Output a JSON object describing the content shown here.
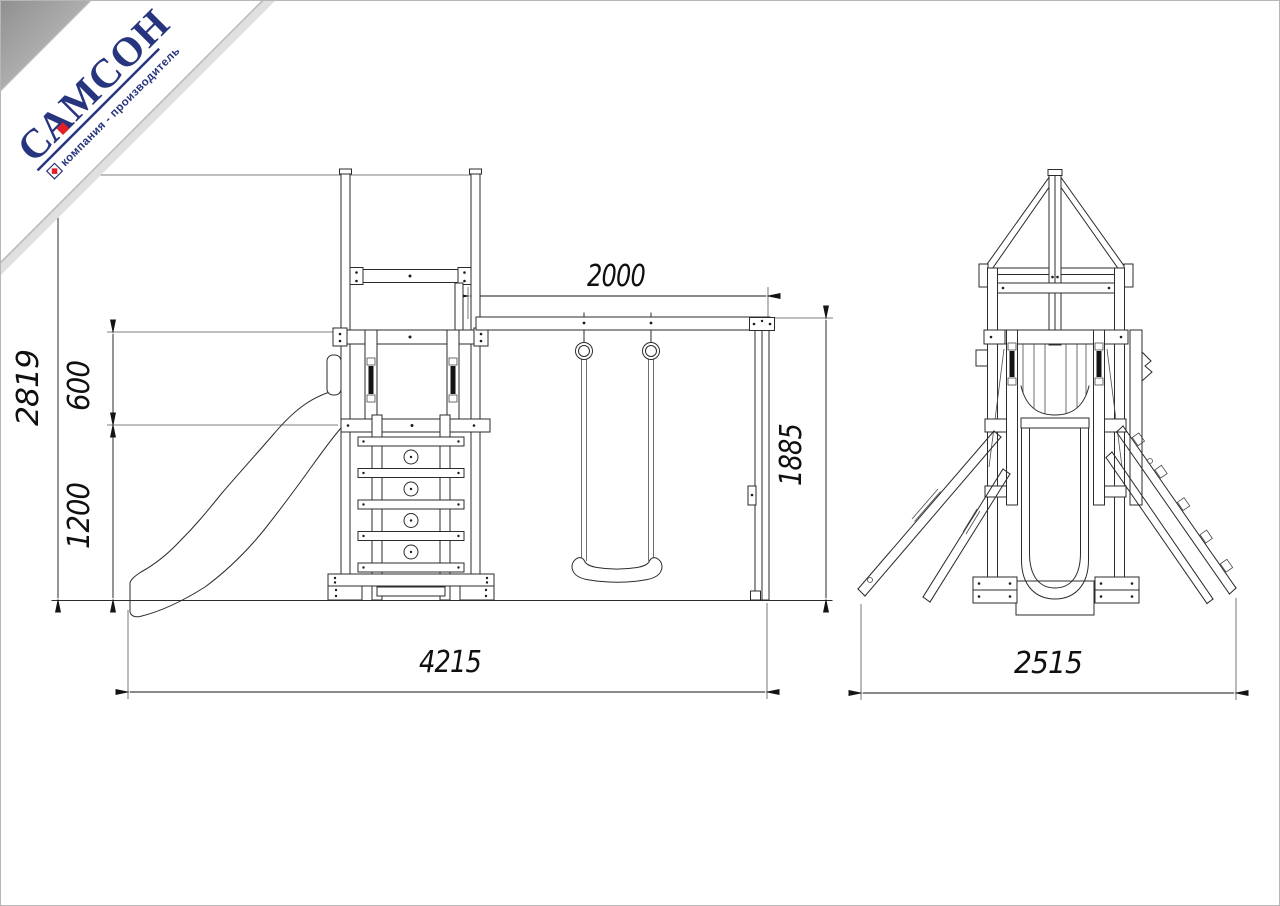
{
  "page": {
    "background": "#ffffff",
    "border_color": "#b6b6b6"
  },
  "logo": {
    "brand": "САМСОН",
    "tagline": "компания - производитель",
    "brand_color": "#27357e",
    "accent_color": "#e31e24",
    "ribbon_color": "#ffffff",
    "corner_color": "#9a9a9a"
  },
  "drawing": {
    "stroke_color": "#2b2b2b",
    "dimension_color": "#141414",
    "dimensions": {
      "total_height_mm": "2819",
      "guardrail_height_mm": "600",
      "deck_height_mm": "1200",
      "swing_span_mm": "2000",
      "swing_frame_height_mm": "1885",
      "overall_length_mm": "4215",
      "overall_depth_mm": "2515"
    }
  }
}
